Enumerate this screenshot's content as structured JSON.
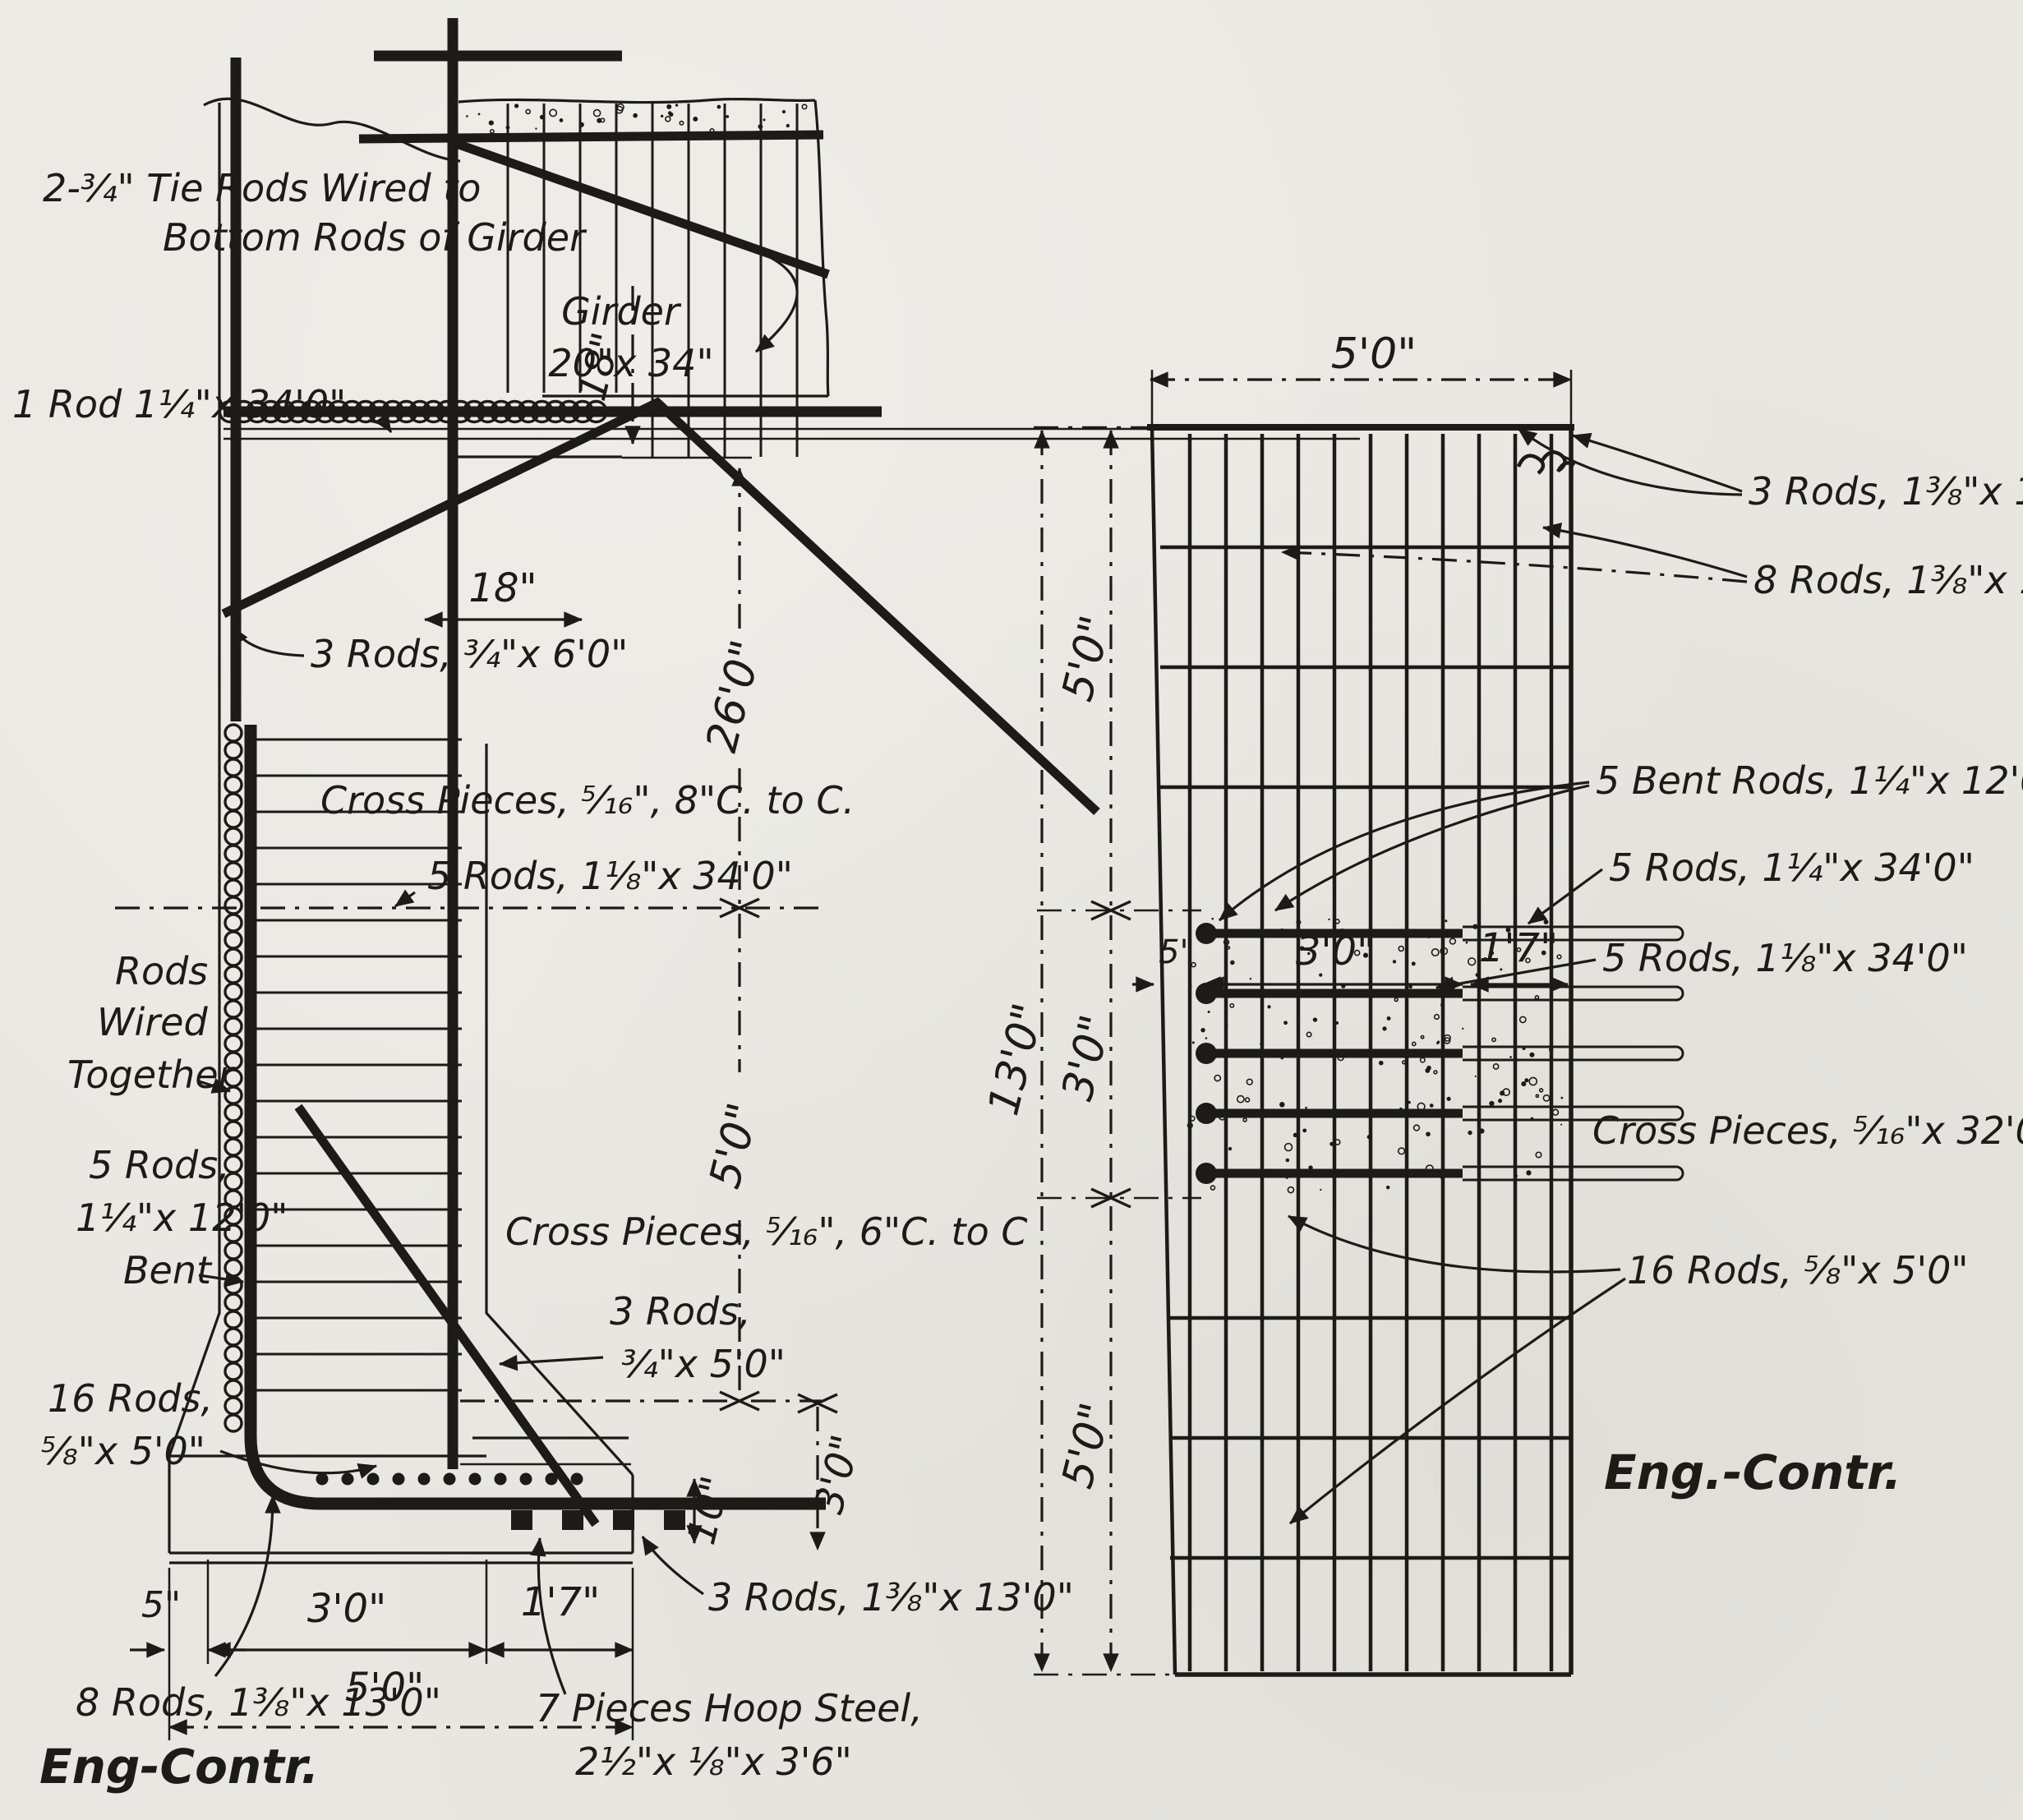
{
  "palette": {
    "paper": "#e9e7e1",
    "ink": "#1d1b17"
  },
  "left_figure": {
    "labels": {
      "tie_rods_l1": "2-¾\" Tie Rods Wired to",
      "tie_rods_l2": "Bottom Rods of Girder",
      "rod_134": "1 Rod 1¼\"x 34'0\"",
      "girder_l1": "Girder",
      "girder_l2": "20\"x 34\"",
      "rods_3_6": "3 Rods, ¾\"x 6'0\"",
      "cross_8": "Cross Pieces, ⁵⁄₁₆\", 8\"C. to C.",
      "rods_5_118": "5 Rods, 1⅛\"x 34'0\"",
      "wired_l1": "Rods",
      "wired_l2": "Wired",
      "wired_l3": "Together",
      "bent_l1": "5 Rods,",
      "bent_l2": "1¼\"x 12'0\"",
      "bent_l3": "Bent",
      "cross_6": "Cross Pieces, ⁵⁄₁₆\", 6\"C. to C",
      "rods_3_5_l1": "3 Rods,",
      "rods_3_5_l2": "¾\"x 5'0\"",
      "rods_16_l1": "16 Rods,",
      "rods_16_l2": "⅝\"x 5'0\"",
      "rods_8": "8 Rods, 1⅜\"x 13'0\"",
      "hoop_l1": "7 Pieces Hoop Steel,",
      "hoop_l2": "2½\"x ⅛\"x 3'6\"",
      "rods_3_13": "3 Rods, 1⅜\"x 13'0\"",
      "credit": "Eng-Contr."
    },
    "dims": {
      "d18v": "18\"",
      "d18h": "18\"",
      "d26": "26'0\"",
      "d5ft": "5'0\"",
      "d3ft": "3'0\"",
      "d10": "10\"",
      "d5in": "5\"",
      "b3ft": "3'0\"",
      "b17": "1'7\"",
      "b5ft": "5'0\""
    }
  },
  "right_figure": {
    "labels": {
      "rods_3_13": "3 Rods, 1⅜\"x 13'0\"",
      "rods_8_13": "8 Rods, 1⅜\"x 13'0\"",
      "bent_5": "5 Bent Rods, 1¼\"x 12'0\"",
      "rods_5_114": "5 Rods, 1¼\"x 34'0\"",
      "rods_5_118": "5 Rods, 1⅛\"x 34'0\"",
      "cross_32": "Cross Pieces, ⁵⁄₁₆\"x 32'0\"",
      "rods_16": "16 Rods, ⅝\"x 5'0\"",
      "credit": "Eng.-Contr."
    },
    "dims": {
      "top5": "5'0\"",
      "left13": "13'0\"",
      "seg5a": "5'0\"",
      "seg3": "3'0\"",
      "seg5b": "5'0\"",
      "c5in": "5\"",
      "c3ft": "3'0\"",
      "c17": "1'7\""
    }
  }
}
